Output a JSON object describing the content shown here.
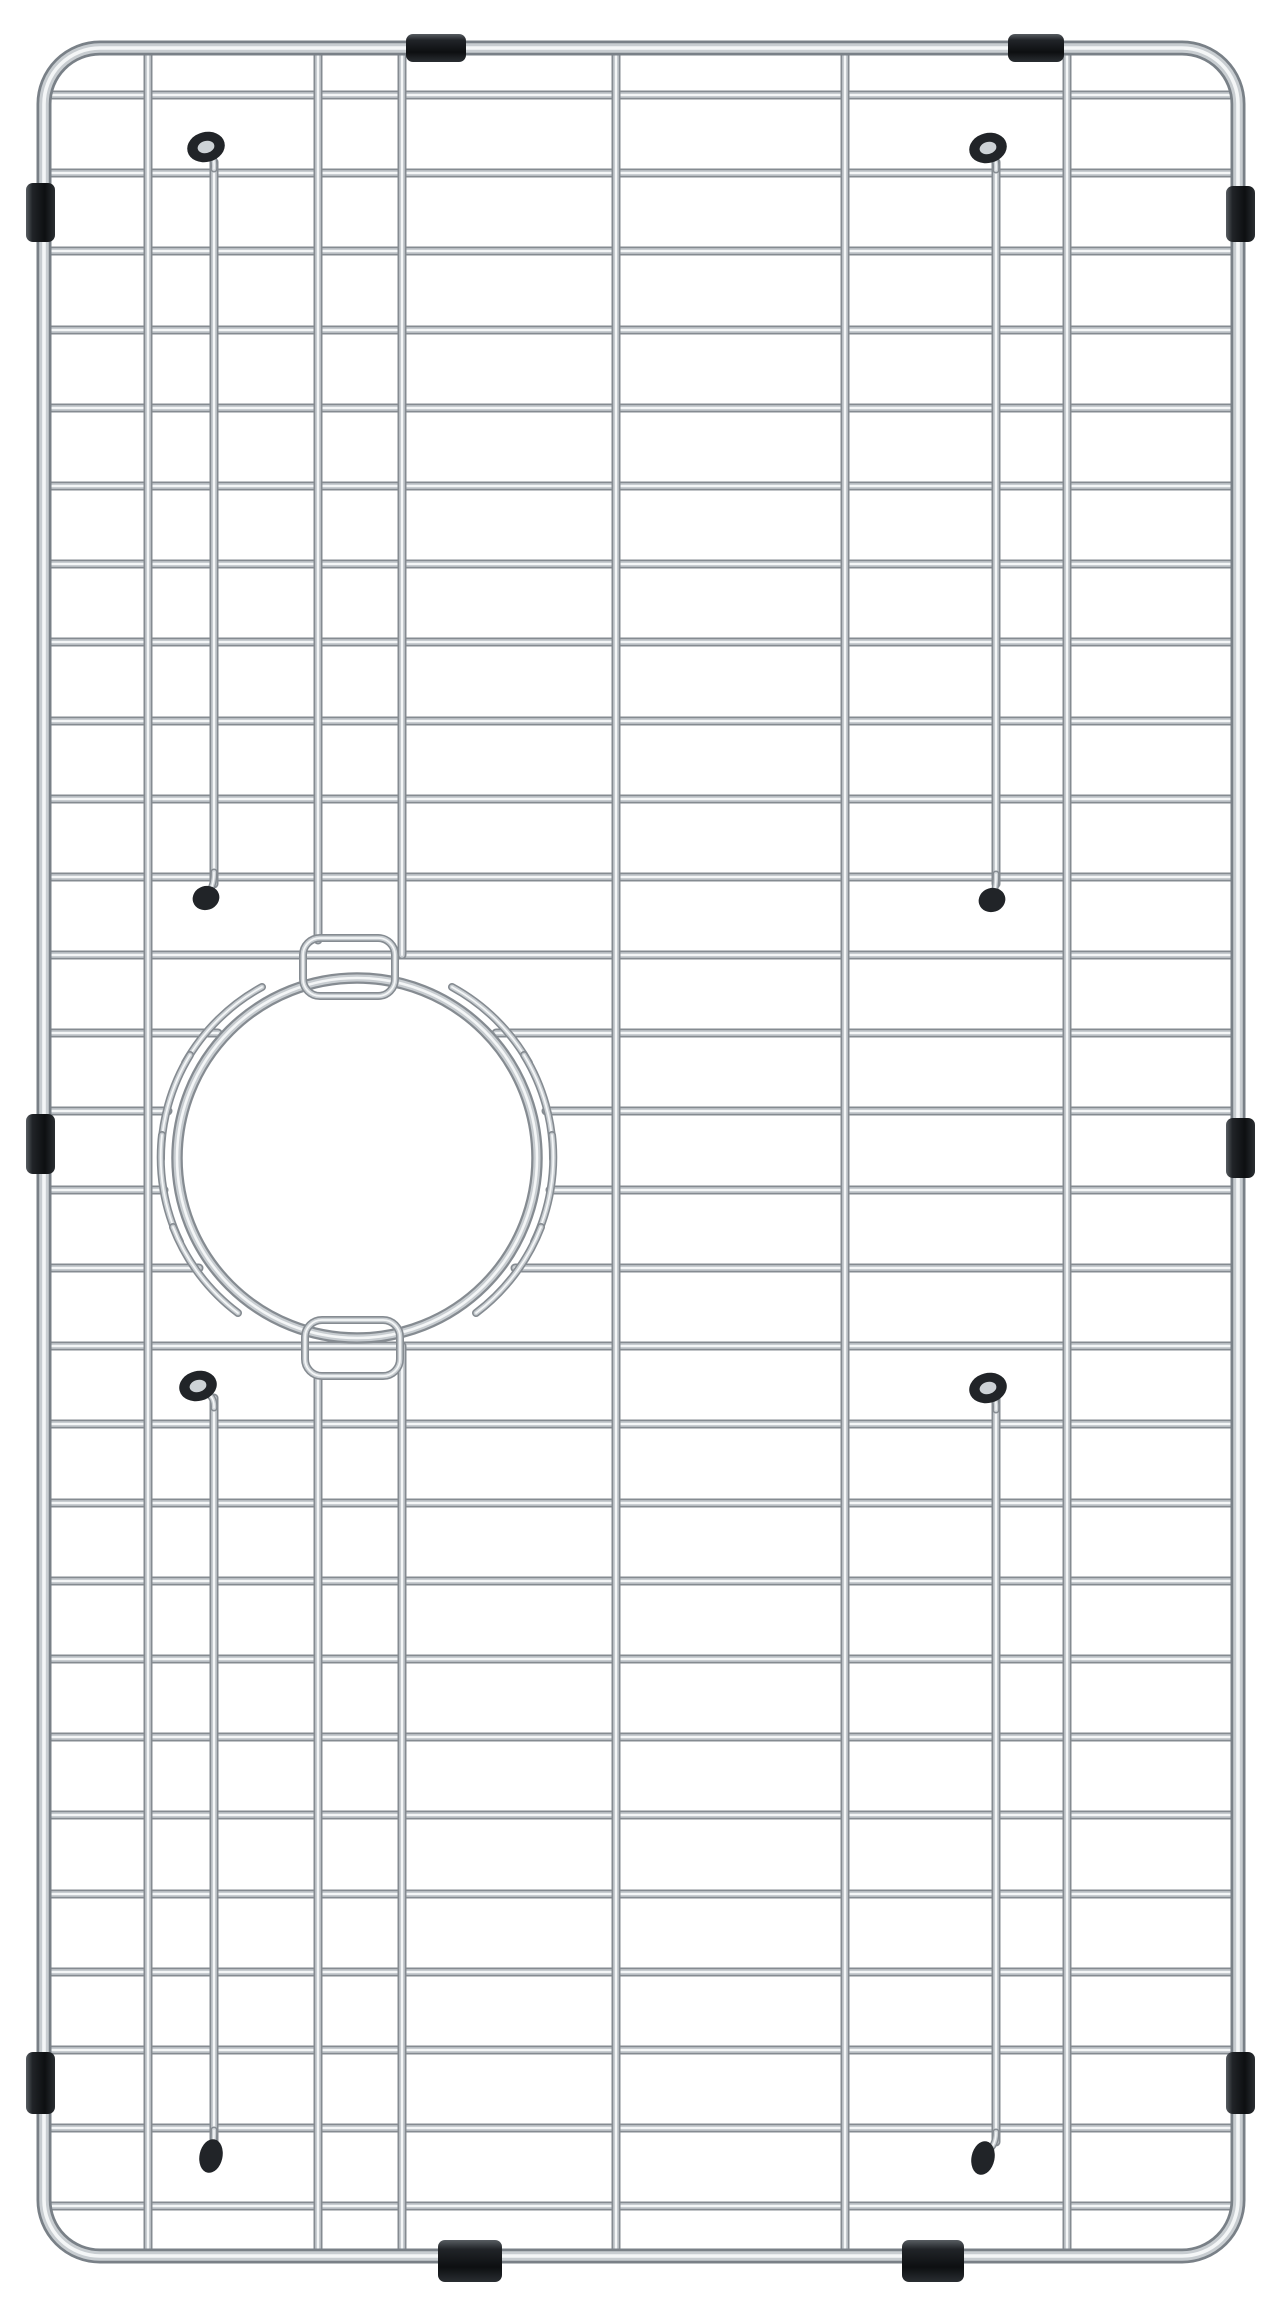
{
  "meta": {
    "subject": "stainless-steel-sink-bottom-grid-product-photo",
    "description": "Top view of a rectangular stainless steel kitchen sink bottom grid with rounded corners, a circular drain opening offset to the lower-left-center, wire hook loops hugging the drain ring, black rubber feet caps and black rubber protective bumpers clipped on the outer frame. Plain white background. No visible text.",
    "background_color": "#ffffff",
    "canvas": {
      "width": 1280,
      "height": 2313
    }
  },
  "palette": {
    "wire_edge": "#858b91",
    "wire_mid": "#c8cdd1",
    "wire_highlight": "#f4f6f7",
    "frame_edge": "#798087",
    "rubber_top": "#585d62",
    "rubber_mid": "#212428",
    "rubber_low": "#0d0f11",
    "rubber_end": "#2a2e32",
    "donut_hole": "#cdd2d6"
  },
  "frame": {
    "x": 44,
    "y": 48,
    "width": 1194,
    "height": 2208,
    "corner_radius": 56,
    "stroke_widths": [
      15,
      9.5,
      3.6
    ]
  },
  "horizontal_wires": {
    "count": 28,
    "first_y": 95,
    "spacing": 78.2,
    "x1": 46,
    "x2": 1236,
    "cut_indices": [
      12,
      13,
      14,
      15
    ],
    "stroke_widths": [
      9,
      5.5,
      2
    ]
  },
  "cut_wire_rows": [
    {
      "y": 1033,
      "left_tip": 218,
      "right_tip": 496
    },
    {
      "y": 1111,
      "left_tip": 168,
      "right_tip": 546
    },
    {
      "y": 1190,
      "left_tip": 164,
      "right_tip": 550
    },
    {
      "y": 1268,
      "left_tip": 199,
      "right_tip": 515
    }
  ],
  "vertical_segments": [
    {
      "x": 148,
      "y1": 48,
      "y2": 2256
    },
    {
      "x": 318,
      "y1": 48,
      "y2": 940
    },
    {
      "x": 318,
      "y1": 1377,
      "y2": 2256
    },
    {
      "x": 402,
      "y1": 48,
      "y2": 955
    },
    {
      "x": 402,
      "y1": 1346,
      "y2": 2256
    },
    {
      "x": 616,
      "y1": 48,
      "y2": 2256
    },
    {
      "x": 845,
      "y1": 48,
      "y2": 2256
    },
    {
      "x": 1067,
      "y1": 48,
      "y2": 2256
    },
    {
      "x": 214,
      "y1": 162,
      "y2": 884
    },
    {
      "x": 214,
      "y1": 1398,
      "y2": 2142
    },
    {
      "x": 996,
      "y1": 162,
      "y2": 884
    },
    {
      "x": 996,
      "y1": 1398,
      "y2": 2142
    }
  ],
  "drain_ring": {
    "cx": 357,
    "cy": 1158,
    "r": 180,
    "stroke_widths": [
      11.5,
      7,
      2.6
    ]
  },
  "ring_tabs": [
    {
      "x": 303,
      "y": 938,
      "w": 92,
      "h": 58,
      "rx": 17
    },
    {
      "x": 305,
      "y": 1320,
      "w": 95,
      "h": 56,
      "rx": 17
    }
  ],
  "ring_hooks": {
    "radius": 196,
    "stroke_widths": [
      8,
      4.8,
      1.8
    ],
    "arcs": [
      {
        "x1": 452,
        "y1": 987,
        "x2": 529,
        "y2": 1063,
        "sweep": 1
      },
      {
        "x1": 524,
        "y1": 1055,
        "x2": 553,
        "y2": 1159,
        "sweep": 1
      },
      {
        "x1": 552,
        "y1": 1135,
        "x2": 534,
        "y2": 1242,
        "sweep": 1
      },
      {
        "x1": 541,
        "y1": 1227,
        "x2": 476,
        "y2": 1313,
        "sweep": 1
      },
      {
        "x1": 262,
        "y1": 987,
        "x2": 185,
        "y2": 1063,
        "sweep": 0
      },
      {
        "x1": 190,
        "y1": 1055,
        "x2": 161,
        "y2": 1159,
        "sweep": 0
      },
      {
        "x1": 162,
        "y1": 1135,
        "x2": 180,
        "y2": 1242,
        "sweep": 0
      },
      {
        "x1": 173,
        "y1": 1227,
        "x2": 238,
        "y2": 1313,
        "sweep": 0
      }
    ]
  },
  "feet": [
    {
      "type": "ring-cap",
      "cap_x": 206,
      "cap_y": 147,
      "wire_x": 214,
      "attach": "below"
    },
    {
      "type": "ring-cap",
      "cap_x": 988,
      "cap_y": 148,
      "wire_x": 996,
      "attach": "below"
    },
    {
      "type": "ball-cap",
      "cap_x": 206,
      "cap_y": 898,
      "wire_x": 214,
      "attach": "above"
    },
    {
      "type": "ball-cap",
      "cap_x": 992,
      "cap_y": 900,
      "wire_x": 996,
      "attach": "above"
    },
    {
      "type": "ring-cap",
      "cap_x": 198,
      "cap_y": 1386,
      "wire_x": 214,
      "attach": "below"
    },
    {
      "type": "ring-cap",
      "cap_x": 988,
      "cap_y": 1388,
      "wire_x": 996,
      "attach": "below"
    },
    {
      "type": "drop-cap",
      "cap_x": 211,
      "cap_y": 2156,
      "wire_x": 214,
      "attach": "above"
    },
    {
      "type": "drop-cap",
      "cap_x": 983,
      "cap_y": 2158,
      "wire_x": 996,
      "attach": "above"
    }
  ],
  "bumpers": [
    {
      "edge": "top",
      "x": 406,
      "y": 34,
      "w": 60,
      "h": 28
    },
    {
      "edge": "top",
      "x": 1008,
      "y": 34,
      "w": 56,
      "h": 28
    },
    {
      "edge": "bottom",
      "x": 438,
      "y": 2240,
      "w": 64,
      "h": 42
    },
    {
      "edge": "bottom",
      "x": 902,
      "y": 2240,
      "w": 62,
      "h": 42
    },
    {
      "edge": "left",
      "x": 26,
      "y": 183,
      "w": 29,
      "h": 59
    },
    {
      "edge": "left",
      "x": 26,
      "y": 1114,
      "w": 29,
      "h": 60
    },
    {
      "edge": "left",
      "x": 26,
      "y": 2052,
      "w": 29,
      "h": 62
    },
    {
      "edge": "right",
      "x": 1226,
      "y": 186,
      "w": 29,
      "h": 56
    },
    {
      "edge": "right",
      "x": 1226,
      "y": 1118,
      "w": 29,
      "h": 60
    },
    {
      "edge": "right",
      "x": 1226,
      "y": 2052,
      "w": 29,
      "h": 62
    }
  ]
}
